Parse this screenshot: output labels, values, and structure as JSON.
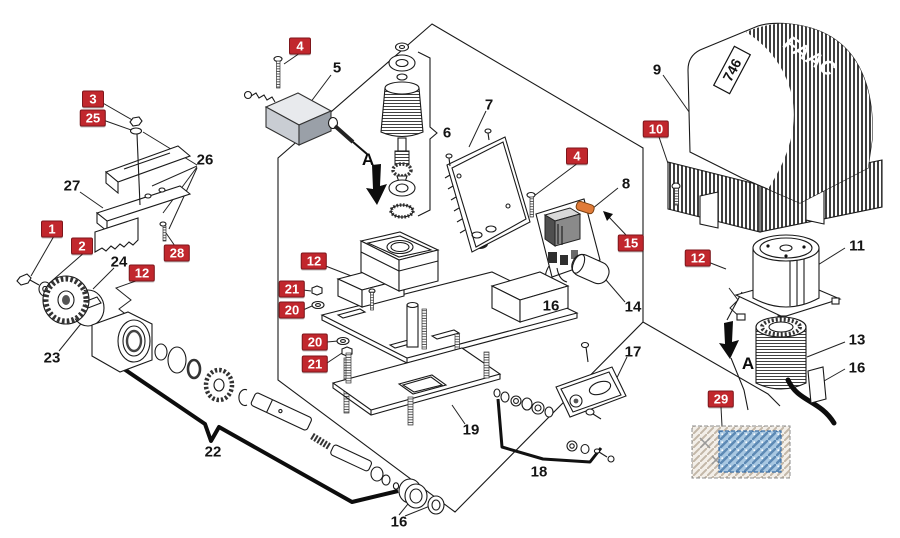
{
  "page": {
    "background": "#ffffff",
    "kind": "exploded-parts-diagram"
  },
  "diagram": {
    "cover": {
      "model_label": "746",
      "brand": "FAAC"
    },
    "label_colors": {
      "red_background": "#c1272d",
      "red_text": "#ffffff",
      "plain_text": "#141414"
    },
    "labels": [
      {
        "text": "4",
        "x": 300,
        "y": 46,
        "style": "red"
      },
      {
        "text": "3",
        "x": 93,
        "y": 99,
        "style": "red"
      },
      {
        "text": "25",
        "x": 93,
        "y": 118,
        "style": "red"
      },
      {
        "text": "1",
        "x": 52,
        "y": 229,
        "style": "red"
      },
      {
        "text": "2",
        "x": 82,
        "y": 246,
        "style": "red"
      },
      {
        "text": "28",
        "x": 177,
        "y": 253,
        "style": "red"
      },
      {
        "text": "12",
        "x": 142,
        "y": 273,
        "style": "red"
      },
      {
        "text": "12",
        "x": 314,
        "y": 261,
        "style": "red"
      },
      {
        "text": "21",
        "x": 292,
        "y": 289,
        "style": "red"
      },
      {
        "text": "20",
        "x": 292,
        "y": 310,
        "style": "red"
      },
      {
        "text": "20",
        "x": 315,
        "y": 342,
        "style": "red"
      },
      {
        "text": "21",
        "x": 315,
        "y": 364,
        "style": "red"
      },
      {
        "text": "4",
        "x": 577,
        "y": 156,
        "style": "red"
      },
      {
        "text": "15",
        "x": 631,
        "y": 243,
        "style": "red"
      },
      {
        "text": "10",
        "x": 656,
        "y": 129,
        "style": "red"
      },
      {
        "text": "12",
        "x": 698,
        "y": 258,
        "style": "red"
      },
      {
        "text": "29",
        "x": 721,
        "y": 399,
        "style": "red"
      },
      {
        "text": "5",
        "x": 337,
        "y": 68,
        "style": "plain"
      },
      {
        "text": "26",
        "x": 205,
        "y": 160,
        "style": "plain"
      },
      {
        "text": "27",
        "x": 72,
        "y": 186,
        "style": "plain"
      },
      {
        "text": "24",
        "x": 119,
        "y": 262,
        "style": "plain"
      },
      {
        "text": "23",
        "x": 52,
        "y": 358,
        "style": "plain"
      },
      {
        "text": "6",
        "x": 447,
        "y": 133,
        "style": "plain"
      },
      {
        "text": "7",
        "x": 489,
        "y": 105,
        "style": "plain"
      },
      {
        "text": "9",
        "x": 657,
        "y": 70,
        "style": "plain"
      },
      {
        "text": "8",
        "x": 626,
        "y": 184,
        "style": "plain"
      },
      {
        "text": "11",
        "x": 857,
        "y": 246,
        "style": "plain"
      },
      {
        "text": "14",
        "x": 633,
        "y": 307,
        "style": "plain"
      },
      {
        "text": "16",
        "x": 551,
        "y": 306,
        "style": "plain"
      },
      {
        "text": "13",
        "x": 857,
        "y": 340,
        "style": "plain"
      },
      {
        "text": "16",
        "x": 857,
        "y": 368,
        "style": "plain"
      },
      {
        "text": "17",
        "x": 633,
        "y": 352,
        "style": "plain"
      },
      {
        "text": "19",
        "x": 471,
        "y": 430,
        "style": "plain"
      },
      {
        "text": "18",
        "x": 539,
        "y": 472,
        "style": "plain"
      },
      {
        "text": "22",
        "x": 213,
        "y": 452,
        "style": "plain"
      },
      {
        "text": "16",
        "x": 399,
        "y": 522,
        "style": "plain"
      },
      {
        "text": "A",
        "x": 368,
        "y": 160,
        "style": "marker"
      },
      {
        "text": "A",
        "x": 748,
        "y": 364,
        "style": "marker"
      }
    ]
  }
}
